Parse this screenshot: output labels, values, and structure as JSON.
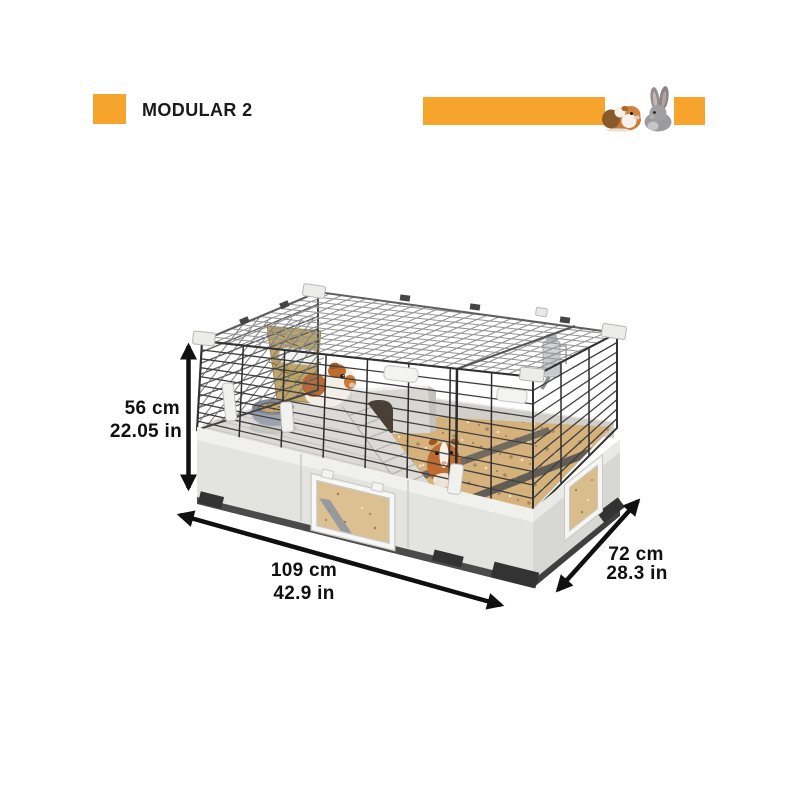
{
  "header": {
    "title": "MODULAR 2",
    "accent_color": "#F6A42C"
  },
  "banner": {
    "animal_icons": [
      "guinea-pig",
      "rabbit"
    ]
  },
  "dimensions": {
    "height": {
      "metric": "56 cm",
      "imperial": "22.05 in"
    },
    "length": {
      "metric": "109 cm",
      "imperial": "42.9 in"
    },
    "depth": {
      "metric": "72 cm",
      "imperial": "28.3 in"
    }
  }
}
